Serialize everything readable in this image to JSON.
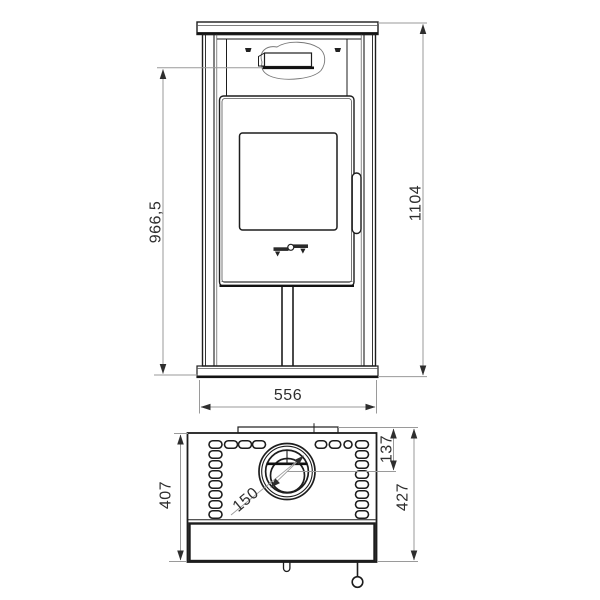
{
  "drawing": {
    "views": [
      "front",
      "top"
    ],
    "dimensions": {
      "front": {
        "lever_height": "966,5",
        "total_height": "1104",
        "width": "556"
      },
      "top": {
        "body_depth": "407",
        "total_depth": "427",
        "flue_center_from_rear": "137",
        "flue_diameter": "150"
      }
    },
    "colors": {
      "background": "#ffffff",
      "outline": "#1d1d1d",
      "dimension_line": "#9a9a9a",
      "dimension_text": "#2e2e2e"
    }
  }
}
